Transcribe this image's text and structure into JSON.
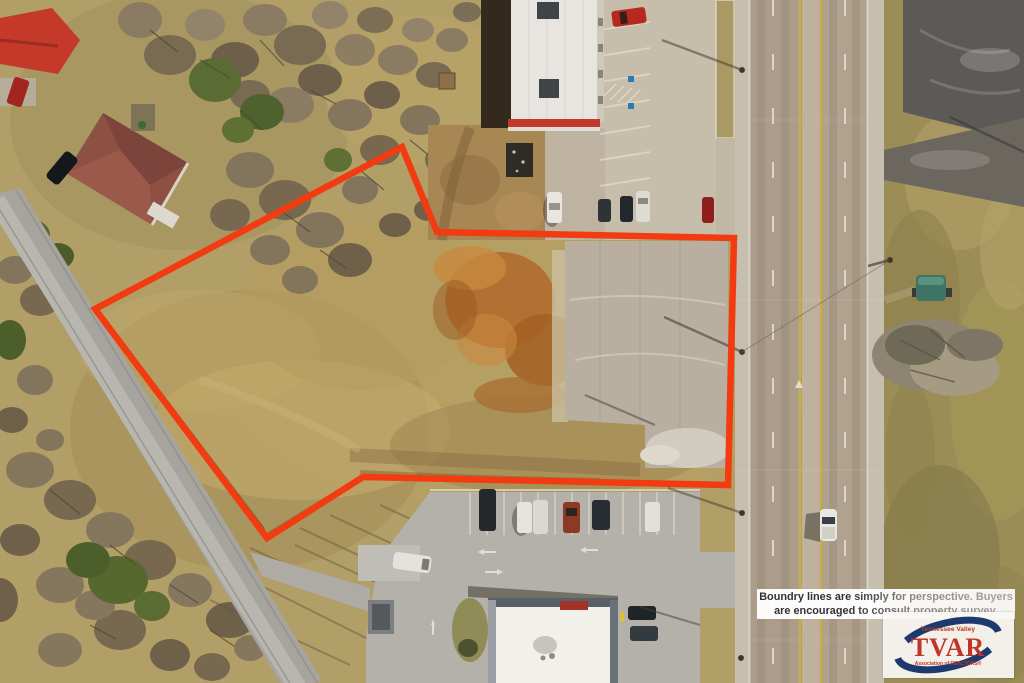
{
  "image": {
    "kind": "aerial-drone-photo",
    "subject": "vacant commercial lot outlined in red next to a divided highway"
  },
  "overlay": {
    "disclaimer": {
      "line1": "Boundry lines are simply for perspective. Buyers",
      "line2": "are encouraged to consult property survey."
    },
    "logo": {
      "region": "Tennessee Valley",
      "acronym": "TVAR",
      "subtitle": "Association of REALTORS®"
    }
  },
  "colors": {
    "boundary": "#f23b10",
    "logo_navy": "#1c3a6e",
    "logo_red": "#c03527",
    "disclaimer_text": "#333333",
    "field_tan": "#b29f67",
    "concrete": "#b8afa1",
    "highway_pavement": "#ab9d8a"
  }
}
